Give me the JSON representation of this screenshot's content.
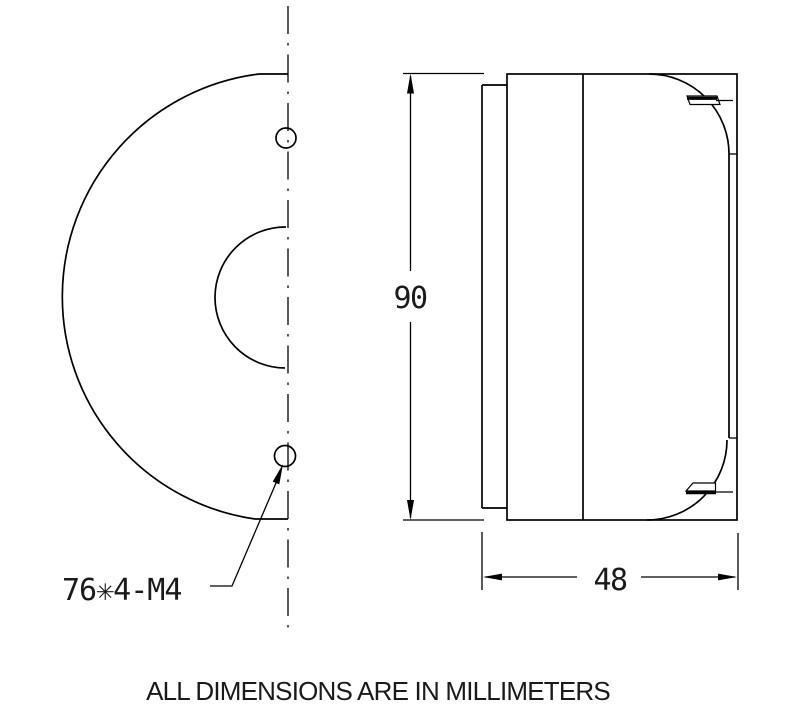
{
  "drawing": {
    "colors": {
      "background": "#ffffff",
      "line": "#000000"
    },
    "dimensions": {
      "height_mm": "90",
      "depth_mm": "48",
      "mounting_holes_label": "76✳4-M4"
    },
    "note": "ALL DIMENSIONS ARE IN MILLIMETERS"
  }
}
